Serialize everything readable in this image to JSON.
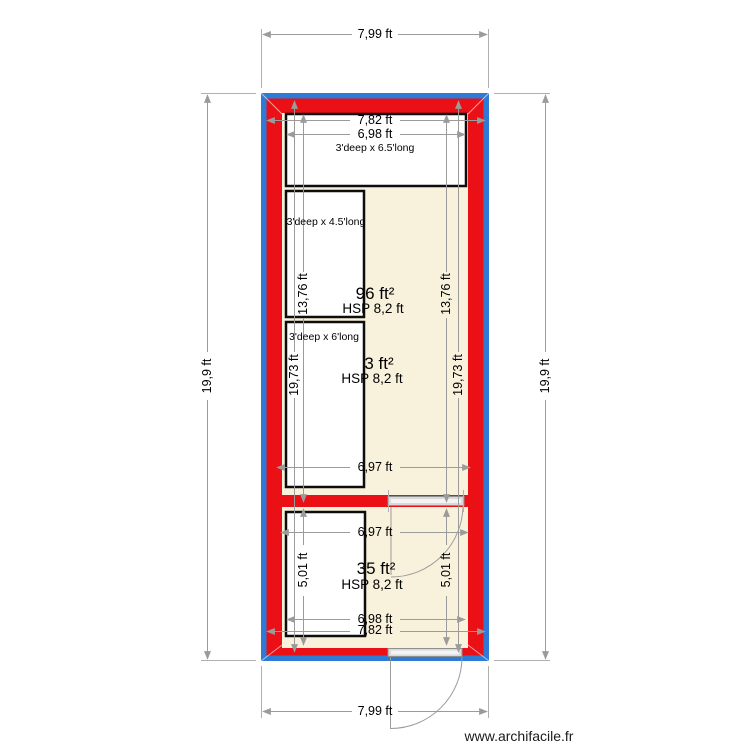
{
  "app": {
    "watermark": "www.archifacile.fr",
    "drawing_type": "floor plan"
  },
  "colors": {
    "wall_outline_blue": "#2f7ad4",
    "wall_fill_red": "#ea1016",
    "floor_cream": "#f8f2dd",
    "closet_fill": "#ffffff",
    "dimension_gray": "#9b9b9b"
  },
  "exterior_dims": {
    "top": "7,99 ft",
    "bottom": "7,99 ft",
    "left": "19,9 ft",
    "right": "19,9 ft"
  },
  "rooms": [
    {
      "name": "upper room",
      "area": "96 ft²",
      "ceiling_height": "HSP 8,2 ft",
      "width_outer": "7,82 ft",
      "width_inner": "6,98 ft",
      "height_left": "13,76 ft",
      "height_right": "13,76 ft",
      "closets": [
        {
          "label": "3'deep x 6.5'long"
        },
        {
          "label": "3'deep x 4.5'long"
        }
      ]
    },
    {
      "name": "middle room",
      "area": "3 ft²",
      "ceiling_height": "HSP 8,2 ft",
      "height_left": "19,73 ft",
      "height_right": "19,73 ft",
      "width_bottom": "6,97 ft",
      "closets": [
        {
          "label": "3'deep x 6'long"
        }
      ]
    },
    {
      "name": "bottom room",
      "area": "35 ft²",
      "ceiling_height": "HSP 8,2 ft",
      "width_top": "6,97 ft",
      "height_left": "5,01 ft",
      "height_right": "5,01 ft",
      "width_inner": "6,98 ft",
      "width_outer": "7,82 ft"
    }
  ]
}
